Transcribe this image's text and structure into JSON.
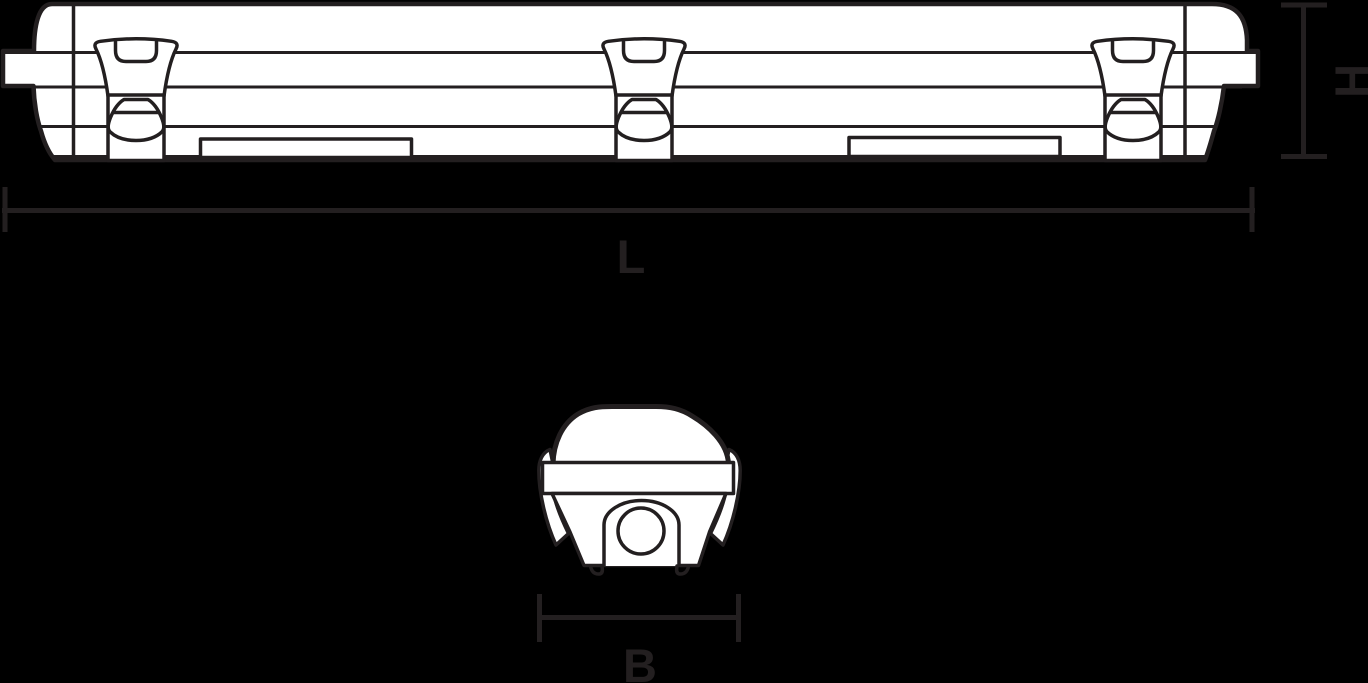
{
  "drawing": {
    "dimension_labels": {
      "length": "L",
      "height": "H",
      "width": "B"
    },
    "colors": {
      "background": "#000000",
      "line": "#231f20",
      "fill": "#ffffff"
    }
  }
}
